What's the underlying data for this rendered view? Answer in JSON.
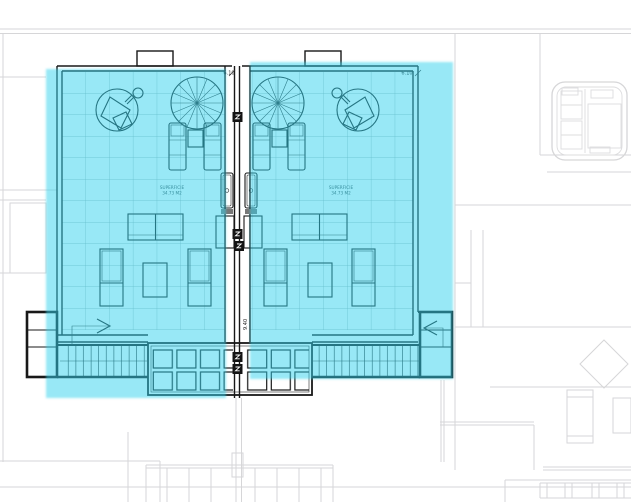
{
  "plan": {
    "dimension_labels": {
      "top_left": "6.10",
      "top_right": "6.10",
      "center_vertical": "9.40"
    },
    "unit_left": {
      "area_line1": "SUPERFICIE",
      "area_line2": "34.73 M2"
    },
    "unit_right": {
      "area_line1": "SUPERFICIE",
      "area_line2": "34.73 M2"
    }
  },
  "highlight": {
    "color": "#2FD1ED",
    "opacity": 0.5,
    "regions": [
      "left-terrace-unit",
      "right-terrace-unit"
    ]
  },
  "colors": {
    "background": "#FFFFFF",
    "plan_line": "#181818",
    "underlay_line": "#D6D6D8",
    "grid_line": "#97A8AA",
    "highlight": "#2FD1ED"
  }
}
